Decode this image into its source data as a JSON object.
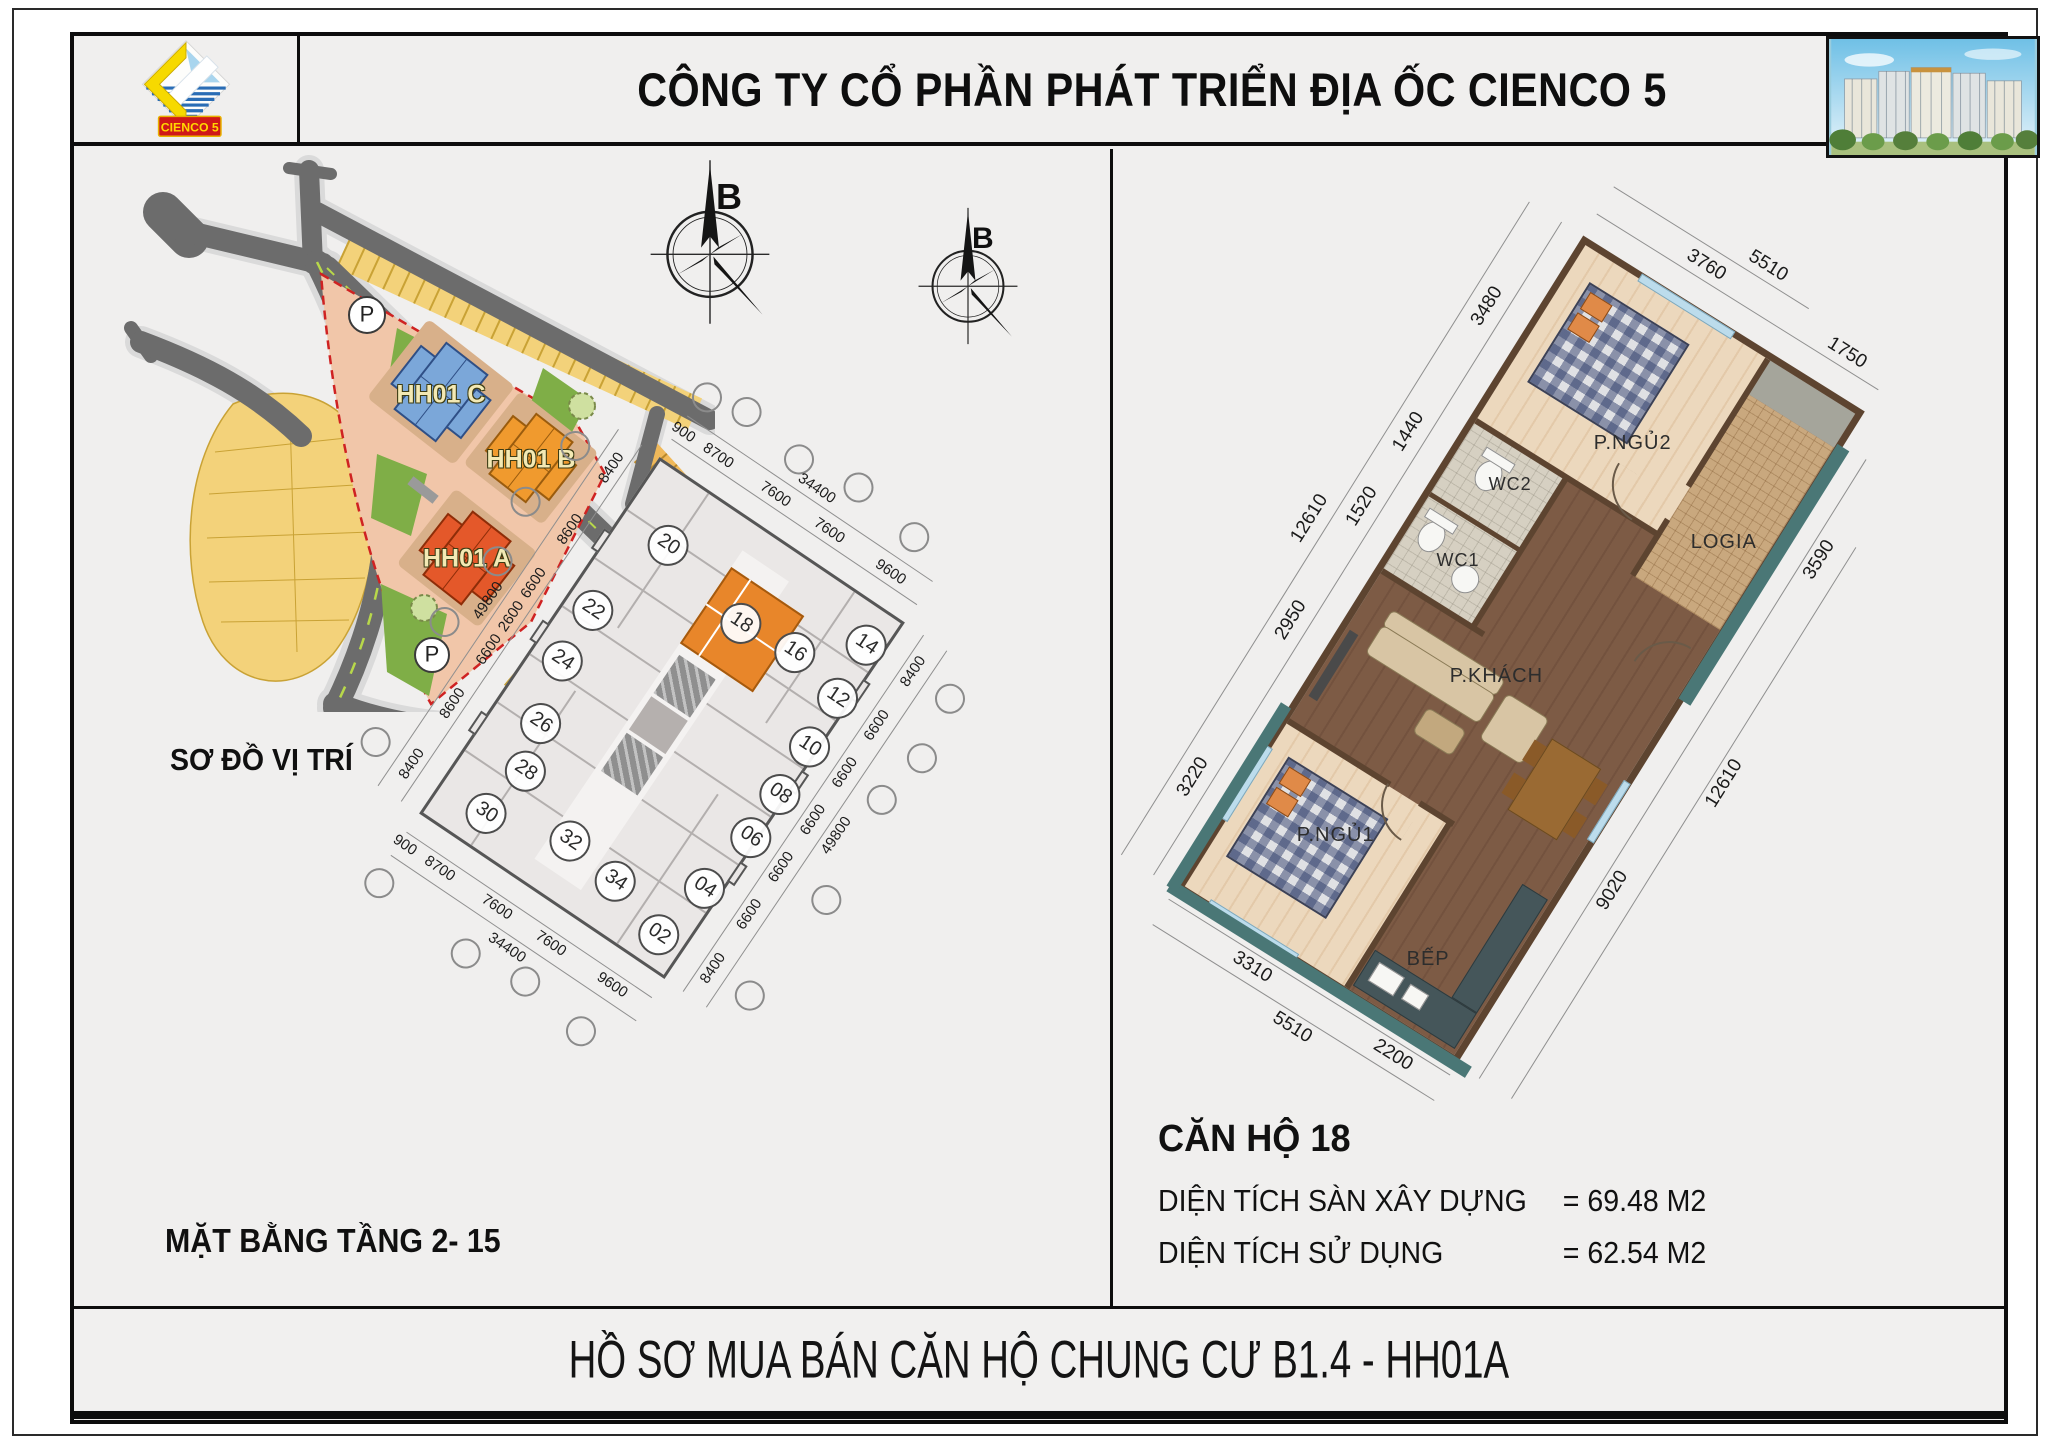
{
  "header": {
    "company_title": "CÔNG TY CỔ PHẦN PHÁT TRIỂN ĐỊA ỐC CIENCO 5",
    "logo_text": "CIENCO 5"
  },
  "site_map": {
    "label": "SƠ ĐỒ VỊ TRÍ",
    "building_c": "HH01 C",
    "building_b": "HH01 B",
    "building_a": "HH01 A",
    "parking": "P"
  },
  "compass": {
    "north_label": "B"
  },
  "floor_plan": {
    "label": "MẶT BẰNG TẦNG 2- 15",
    "units": [
      "20",
      "22",
      "24",
      "26",
      "28",
      "30",
      "32",
      "34",
      "18",
      "16",
      "14",
      "12",
      "10",
      "08",
      "06",
      "04",
      "02"
    ],
    "dims_top": [
      "900",
      "8700",
      "7600",
      "7600",
      "9600"
    ],
    "dims_top_total": "34400",
    "dims_left": [
      "8400",
      "8600",
      "6600",
      "2600",
      "6600",
      "8600",
      "8400"
    ],
    "dims_left_total": "49800",
    "dims_right": [
      "8400",
      "6600",
      "6600",
      "6600",
      "6600",
      "6600",
      "8400"
    ],
    "dims_right_total": "49800",
    "dims_bottom": [
      "900",
      "8700",
      "7600",
      "7600",
      "9600"
    ],
    "dims_bottom_total": "34400"
  },
  "apartment": {
    "title": "CĂN HỘ 18",
    "rooms": {
      "bedroom2": "P.NGỦ2",
      "logia": "LOGIA",
      "wc2": "WC2",
      "wc1": "WC1",
      "living": "P.KHÁCH",
      "bedroom1": "P.NGỦ1",
      "kitchen": "BẾP"
    },
    "dims": {
      "left": [
        "3480",
        "1440",
        "1520",
        "2950",
        "3220"
      ],
      "left_total": "12610",
      "top": [
        "3760",
        "1750"
      ],
      "top_total": "5510",
      "right": [
        "3590",
        "9020"
      ],
      "right_total": "12610",
      "bottom": [
        "3310",
        "2200"
      ],
      "bottom_total": "5510"
    },
    "area_rows": [
      {
        "label": "DIỆN TÍCH SÀN XÂY DỰNG",
        "value": "= 69.48 M2"
      },
      {
        "label": "DIỆN TÍCH SỬ DỤNG",
        "value": "= 62.54 M2"
      }
    ]
  },
  "footer": {
    "title": "HỒ SƠ MUA BÁN CĂN HỘ CHUNG CƯ B1.4 - HH01A"
  }
}
